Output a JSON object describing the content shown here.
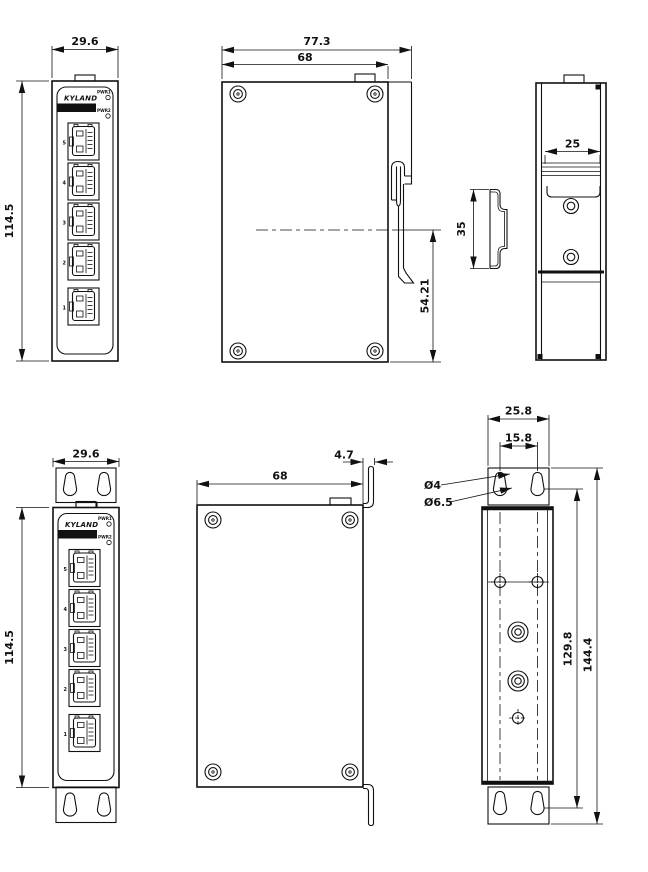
{
  "front_panel": {
    "logo": "KYLAND",
    "led1": "PWR1",
    "led2": "PWR2",
    "ports": [
      "5",
      "4",
      "3",
      "2",
      "1"
    ]
  },
  "views": {
    "front_din": {
      "width": "29.6",
      "height": "114.5"
    },
    "side_din": {
      "overall_width": "77.3",
      "body_width": "68",
      "rail_center_to_bottom": "54.21"
    },
    "rear_din": {
      "clip_width": "25",
      "rail_height": "35"
    },
    "front_wall": {
      "width": "29.6",
      "height": "114.5"
    },
    "side_wall": {
      "body_width": "68",
      "bracket_offset": "4.7"
    },
    "rear_wall": {
      "bracket_width": "25.8",
      "hole_spacing": "15.8",
      "small_hole": "Ø4",
      "large_hole": "Ø6.5",
      "hole_span": "129.8",
      "overall_span": "144.4"
    }
  },
  "colors": {
    "line": "#111111",
    "background": "#ffffff"
  }
}
